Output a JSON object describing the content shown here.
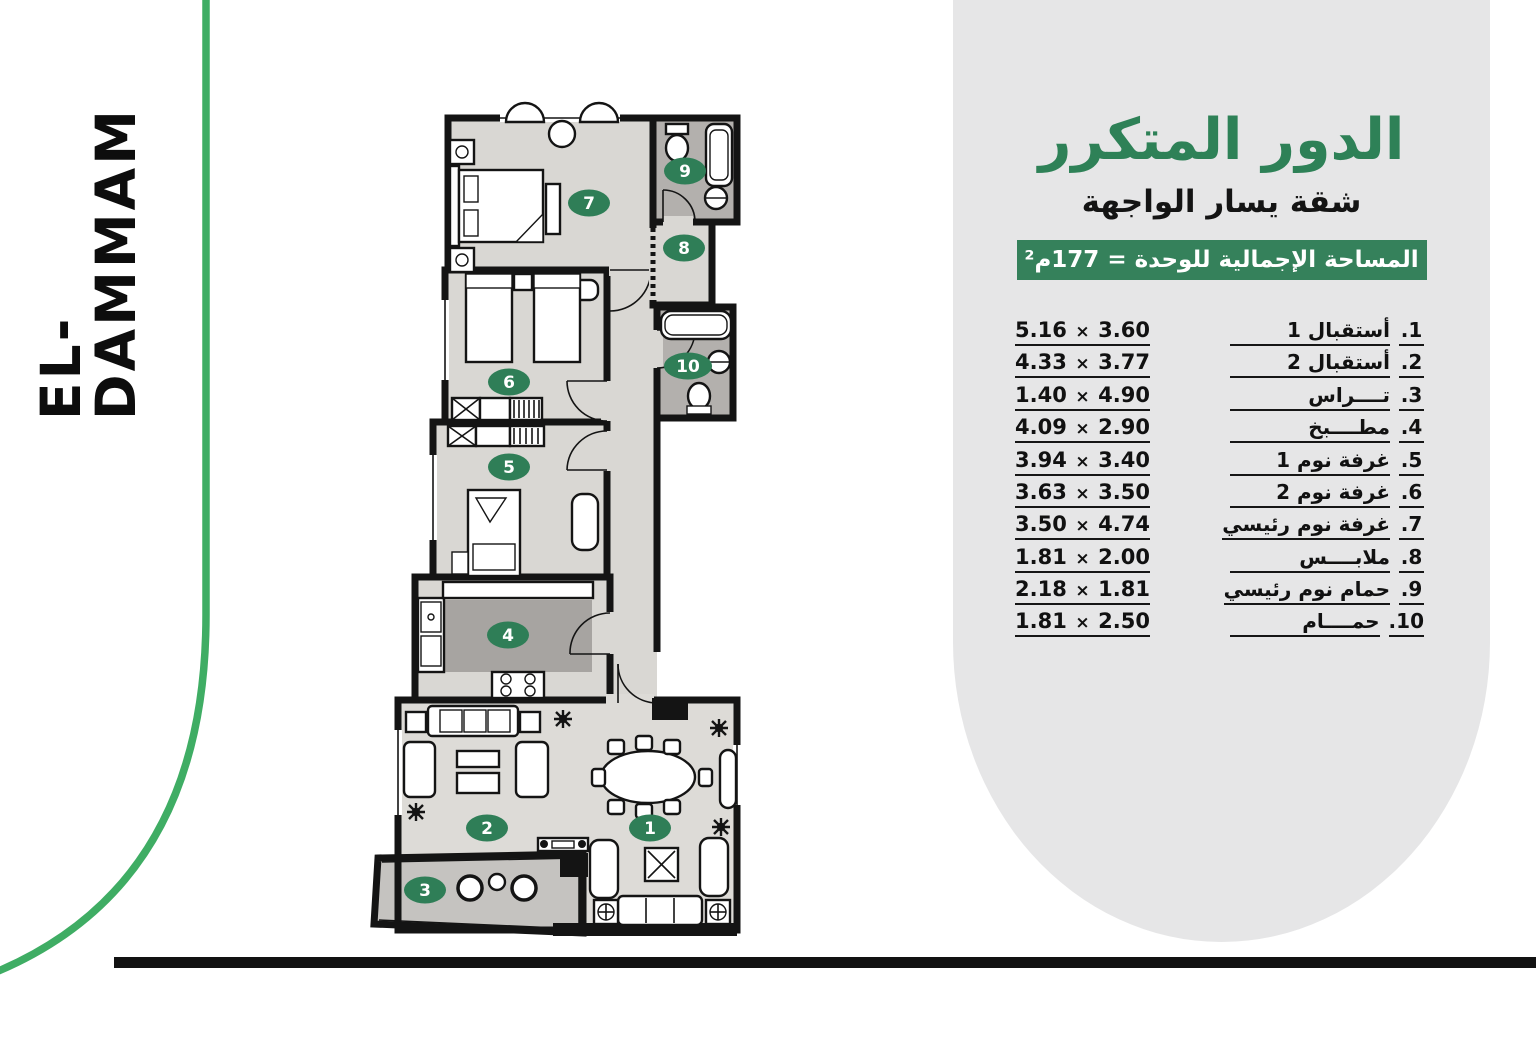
{
  "brand": {
    "logo_text": "EL-DAMMAM"
  },
  "colors": {
    "accent_green": "#2F7E57",
    "line_green": "#3FAD64",
    "panel_gray": "#E6E6E7",
    "floor_light": "#D9D7D3",
    "floor_dark": "#B3B0AD",
    "wall_black": "#141414"
  },
  "panel": {
    "title": "الدور المتكرر",
    "subtitle": "شقة يسار الواجهة",
    "area_banner": "المساحة الإجمالية للوحدة = 177م²",
    "times_symbol": "×",
    "rooms": [
      {
        "num": "1.",
        "name": "أستقبال 1",
        "dim_a": "5.16",
        "dim_b": "3.60"
      },
      {
        "num": "2.",
        "name": "أستقبال 2",
        "dim_a": "4.33",
        "dim_b": "3.77"
      },
      {
        "num": "3.",
        "name": "تــــراس",
        "dim_a": "1.40",
        "dim_b": "4.90"
      },
      {
        "num": "4.",
        "name": "مطــــبخ",
        "dim_a": "4.09",
        "dim_b": "2.90"
      },
      {
        "num": "5.",
        "name": "غرفة نوم 1",
        "dim_a": "3.94",
        "dim_b": "3.40"
      },
      {
        "num": "6.",
        "name": "غرفة نوم 2",
        "dim_a": "3.63",
        "dim_b": "3.50"
      },
      {
        "num": "7.",
        "name": "غرفة نوم رئيسي",
        "dim_a": "3.50",
        "dim_b": "4.74"
      },
      {
        "num": "8.",
        "name": "ملابــــس",
        "dim_a": "1.81",
        "dim_b": "2.00"
      },
      {
        "num": "9.",
        "name": "حمام نوم رئيسي",
        "dim_a": "2.18",
        "dim_b": "1.81"
      },
      {
        "num": "10.",
        "name": "حمــــام",
        "dim_a": "1.81",
        "dim_b": "2.50"
      }
    ]
  },
  "plan": {
    "badges": [
      "1",
      "2",
      "3",
      "4",
      "5",
      "6",
      "7",
      "8",
      "9",
      "10"
    ]
  }
}
